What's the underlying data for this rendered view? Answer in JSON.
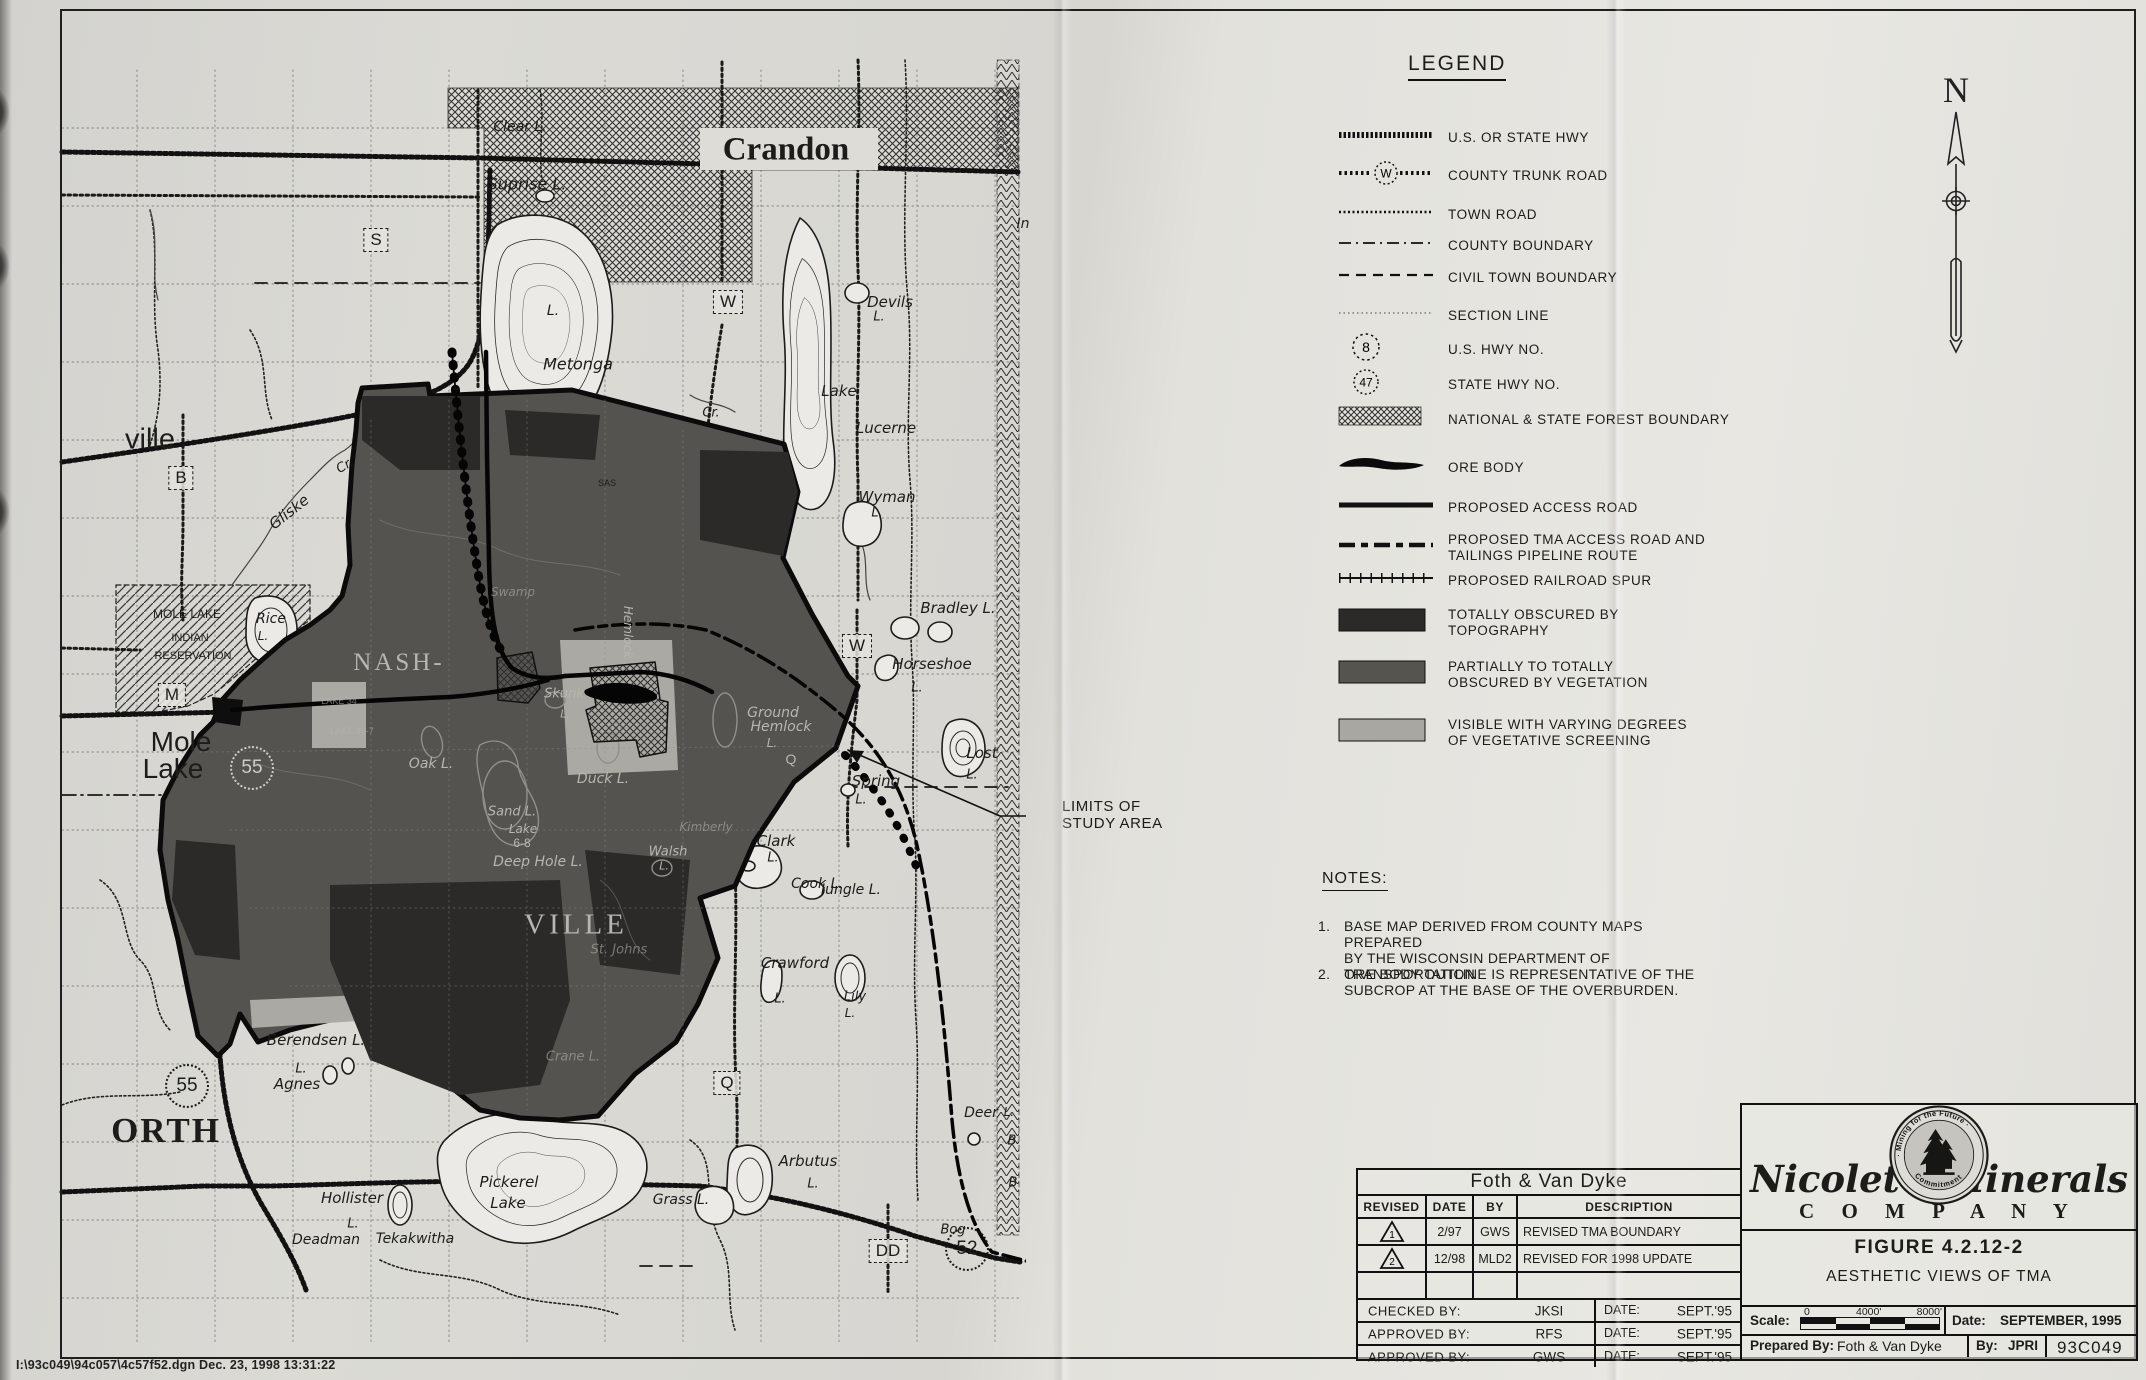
{
  "sheet": {
    "file_line": "I:\\93c049\\94c057\\4c57f52.dgn  Dec. 23, 1998  13:31:22"
  },
  "north_arrow": {
    "label": "N"
  },
  "colors": {
    "paper": "#e2e1dc",
    "ink": "#1c1c1a",
    "obscured_topography": "#2b2a28",
    "obscured_vegetation": "#55534f",
    "visible_screening": "#a9a7a2"
  },
  "legend": {
    "title": "LEGEND",
    "items": [
      {
        "symbol": "hwy",
        "label": "U.S. OR STATE HWY"
      },
      {
        "symbol": "trunk",
        "badge": "W",
        "label": "COUNTY TRUNK ROAD"
      },
      {
        "symbol": "town-road",
        "label": "TOWN ROAD"
      },
      {
        "symbol": "county-boundary",
        "label": "COUNTY BOUNDARY"
      },
      {
        "symbol": "civil-boundary",
        "label": "CIVIL TOWN BOUNDARY"
      },
      {
        "symbol": "section-line",
        "label": "SECTION LINE"
      },
      {
        "symbol": "us-hwy-badge",
        "badge": "8",
        "label": "U.S. HWY NO."
      },
      {
        "symbol": "state-hwy-badge",
        "badge": "47",
        "label": "STATE HWY NO."
      },
      {
        "symbol": "forest-hatch",
        "label": "NATIONAL & STATE FOREST BOUNDARY"
      },
      {
        "symbol": "ore-body",
        "label": "ORE BODY"
      },
      {
        "symbol": "access-road",
        "label": "PROPOSED ACCESS ROAD"
      },
      {
        "symbol": "tma-access",
        "label": "PROPOSED TMA ACCESS ROAD AND\nTAILINGS PIPELINE ROUTE"
      },
      {
        "symbol": "rail-spur",
        "label": "PROPOSED RAILROAD SPUR"
      },
      {
        "symbol": "swatch-dark",
        "label": "TOTALLY OBSCURED BY\nTOPOGRAPHY"
      },
      {
        "symbol": "swatch-medium",
        "label": "PARTIALLY TO TOTALLY\nOBSCURED BY VEGETATION"
      },
      {
        "symbol": "swatch-light",
        "label": "VISIBLE WITH VARYING DEGREES\nOF VEGETATIVE SCREENING"
      }
    ]
  },
  "notes": {
    "title": "NOTES:",
    "items": [
      "BASE MAP DERIVED FROM COUNTY MAPS PREPARED\nBY THE WISCONSIN DEPARTMENT OF TRANSPORTATION",
      "ORE BODY OUTLINE IS REPRESENTATIVE OF THE\nSUBCROP AT THE BASE OF THE OVERBURDEN."
    ]
  },
  "annotation": {
    "limits_lines": [
      "LIMITS OF",
      "STUDY AREA"
    ]
  },
  "title_block": {
    "firm": "Foth & Van Dyke",
    "rev_headers": [
      "REVISED",
      "DATE",
      "BY",
      "DESCRIPTION"
    ],
    "revisions": [
      {
        "mark": "1",
        "date": "2/97",
        "by": "GWS",
        "description": "REVISED TMA BOUNDARY"
      },
      {
        "mark": "2",
        "date": "12/98",
        "by": "MLD2",
        "description": "REVISED FOR 1998 UPDATE"
      }
    ],
    "signoff": [
      {
        "label": "CHECKED BY:",
        "name": "JKSI",
        "date_label": "DATE:",
        "date": "SEPT.'95"
      },
      {
        "label": "APPROVED BY:",
        "name": "RFS",
        "date_label": "DATE:",
        "date": "SEPT.'95"
      },
      {
        "label": "APPROVED BY:",
        "name": "GWS",
        "date_label": "DATE:",
        "date": "SEPT.'95"
      }
    ],
    "company": {
      "name_left": "Nicolet",
      "name_right": "Minerals",
      "company_word": "C O M P A N Y",
      "seal_top": "· Mining for the Future ·",
      "seal_bottom": "Commitment"
    },
    "figure_no": "FIGURE 4.2.12-2",
    "figure_title": "AESTHETIC VIEWS OF TMA",
    "scale_label": "Scale:",
    "scale_ticks": [
      "0",
      "4000'",
      "8000'"
    ],
    "date_label": "Date:",
    "date_value": "SEPTEMBER, 1995",
    "prepared_label": "Prepared By:",
    "prepared_value": "Foth & Van Dyke",
    "by_label": "By:",
    "by_value": "JPRI",
    "job_no": "93C049"
  },
  "map": {
    "boxes": [
      {
        "l": "S",
        "x": 376,
        "y": 240
      },
      {
        "l": "W",
        "x": 728,
        "y": 302
      },
      {
        "l": "B",
        "x": 181,
        "y": 478
      },
      {
        "l": "M",
        "x": 172,
        "y": 695
      },
      {
        "l": "W",
        "x": 857,
        "y": 646
      },
      {
        "l": "Q",
        "x": 727,
        "y": 1083
      },
      {
        "l": "DD",
        "x": 888,
        "y": 1251
      }
    ],
    "circles": [
      {
        "n": "55",
        "x": 252,
        "y": 768,
        "lt": 1
      },
      {
        "n": "55",
        "x": 187,
        "y": 1086
      },
      {
        "n": "52",
        "x": 967,
        "y": 1249
      }
    ],
    "labels": [
      {
        "t": "Crandon",
        "x": 786,
        "y": 150,
        "s": 33,
        "f": 1,
        "b": 1
      },
      {
        "t": "ville",
        "x": 150,
        "y": 440,
        "s": 29
      },
      {
        "t": "Mole",
        "x": 181,
        "y": 742,
        "s": 28
      },
      {
        "t": "Lake",
        "x": 173,
        "y": 769,
        "s": 28
      },
      {
        "t": "NASH-",
        "x": 399,
        "y": 663,
        "s": 25,
        "f": 1,
        "l": 1,
        "k": 3
      },
      {
        "t": "VILLE",
        "x": 576,
        "y": 925,
        "s": 29,
        "f": 1,
        "l": 1,
        "k": 4
      },
      {
        "t": "ORTH",
        "x": 166,
        "y": 1131,
        "s": 35,
        "f": 1,
        "b": 1,
        "k": 2
      },
      {
        "t": "Clear L.",
        "x": 520,
        "y": 127,
        "s": 14,
        "it": 1
      },
      {
        "t": "Suprise L.",
        "x": 527,
        "y": 184,
        "s": 16,
        "it": 1
      },
      {
        "t": "L.",
        "x": 553,
        "y": 311,
        "s": 14,
        "it": 1
      },
      {
        "t": "Metonga",
        "x": 578,
        "y": 364,
        "s": 16,
        "it": 1
      },
      {
        "t": "Cr.",
        "x": 711,
        "y": 413,
        "s": 13,
        "it": 1
      },
      {
        "t": "Devils",
        "x": 890,
        "y": 302,
        "s": 15,
        "it": 1
      },
      {
        "t": "L.",
        "x": 879,
        "y": 317,
        "s": 13,
        "it": 1
      },
      {
        "t": "Lake",
        "x": 839,
        "y": 391,
        "s": 15,
        "it": 1
      },
      {
        "t": "Lucerne",
        "x": 886,
        "y": 428,
        "s": 15,
        "it": 1
      },
      {
        "t": "Wyman",
        "x": 887,
        "y": 497,
        "s": 15,
        "it": 1
      },
      {
        "t": "L.",
        "x": 877,
        "y": 513,
        "s": 13,
        "it": 1
      },
      {
        "t": "In",
        "x": 1023,
        "y": 224,
        "s": 14,
        "it": 1
      },
      {
        "t": "SAS",
        "x": 607,
        "y": 483,
        "s": 9
      },
      {
        "t": "Gliske",
        "x": 289,
        "y": 512,
        "s": 15,
        "it": 1,
        "r": -38
      },
      {
        "t": "Cr.",
        "x": 345,
        "y": 466,
        "s": 13,
        "it": 1,
        "r": -30
      },
      {
        "t": "Rice",
        "x": 271,
        "y": 619,
        "s": 14,
        "it": 1
      },
      {
        "t": "L.",
        "x": 263,
        "y": 636,
        "s": 12,
        "it": 1
      },
      {
        "t": "MOLE LAKE",
        "x": 187,
        "y": 614,
        "s": 12
      },
      {
        "t": "INDIAN",
        "x": 190,
        "y": 638,
        "s": 11
      },
      {
        "t": "RESERVATION",
        "x": 193,
        "y": 656,
        "s": 11
      },
      {
        "t": "Bradley L.",
        "x": 958,
        "y": 608,
        "s": 15,
        "it": 1
      },
      {
        "t": "Horseshoe",
        "x": 932,
        "y": 664,
        "s": 15,
        "it": 1
      },
      {
        "t": "L.",
        "x": 917,
        "y": 688,
        "s": 13,
        "it": 1
      },
      {
        "t": "Ground",
        "x": 773,
        "y": 713,
        "s": 14,
        "it": 1,
        "l": 1
      },
      {
        "t": "Hemlock",
        "x": 781,
        "y": 727,
        "s": 14,
        "it": 1,
        "l": 1
      },
      {
        "t": "L.",
        "x": 772,
        "y": 743,
        "s": 12,
        "it": 1,
        "l": 1
      },
      {
        "t": "Q",
        "x": 791,
        "y": 759,
        "s": 14,
        "l": 1
      },
      {
        "t": "Lost",
        "x": 982,
        "y": 753,
        "s": 15,
        "it": 1
      },
      {
        "t": "L.",
        "x": 972,
        "y": 775,
        "s": 13,
        "it": 1
      },
      {
        "t": "Spring",
        "x": 876,
        "y": 781,
        "s": 15,
        "it": 1
      },
      {
        "t": "L.",
        "x": 861,
        "y": 800,
        "s": 13,
        "it": 1
      },
      {
        "t": "Clark",
        "x": 776,
        "y": 841,
        "s": 15,
        "it": 1
      },
      {
        "t": "L.",
        "x": 773,
        "y": 858,
        "s": 13,
        "it": 1
      },
      {
        "t": "Cook L.",
        "x": 817,
        "y": 884,
        "s": 14,
        "it": 1
      },
      {
        "t": "Jungle L.",
        "x": 851,
        "y": 890,
        "s": 14,
        "it": 1
      },
      {
        "t": "Walsh",
        "x": 668,
        "y": 852,
        "s": 13,
        "it": 1,
        "l": 1
      },
      {
        "t": "L.",
        "x": 664,
        "y": 866,
        "s": 11,
        "it": 1,
        "l": 1
      },
      {
        "t": "Oak L.",
        "x": 431,
        "y": 764,
        "s": 14,
        "it": 1,
        "l": 1
      },
      {
        "t": "Duck L.",
        "x": 603,
        "y": 779,
        "s": 14,
        "it": 1,
        "l": 1
      },
      {
        "t": "Skunk",
        "x": 564,
        "y": 694,
        "s": 13,
        "it": 1,
        "l": 1
      },
      {
        "t": "L.",
        "x": 565,
        "y": 714,
        "s": 11,
        "it": 1,
        "l": 1
      },
      {
        "t": "Sand L.",
        "x": 512,
        "y": 812,
        "s": 13,
        "it": 1,
        "l": 1
      },
      {
        "t": "Lake",
        "x": 523,
        "y": 829,
        "s": 12,
        "it": 1,
        "l": 1
      },
      {
        "t": "6-8",
        "x": 522,
        "y": 843,
        "s": 12,
        "l": 1
      },
      {
        "t": "Deep Hole L.",
        "x": 538,
        "y": 862,
        "s": 14,
        "it": 1,
        "l": 1
      },
      {
        "t": "LAKE 34",
        "x": 339,
        "y": 701,
        "s": 9,
        "l": 1,
        "o": 0.6
      },
      {
        "t": "LAKE 35-7",
        "x": 352,
        "y": 731,
        "s": 9,
        "l": 1,
        "o": 0.6
      },
      {
        "t": "Hemlock",
        "x": 628,
        "y": 632,
        "s": 12,
        "it": 1,
        "l": 1,
        "r": 90
      },
      {
        "t": "St. Johns",
        "x": 619,
        "y": 950,
        "s": 13,
        "it": 1,
        "l": 1,
        "o": 0.55
      },
      {
        "t": "Crane L.",
        "x": 573,
        "y": 1057,
        "s": 13,
        "it": 1,
        "l": 1,
        "o": 0.55
      },
      {
        "t": "Kimberly",
        "x": 706,
        "y": 827,
        "s": 12,
        "it": 1,
        "l": 1,
        "o": 0.55
      },
      {
        "t": "Swamp",
        "x": 513,
        "y": 592,
        "s": 12,
        "it": 1,
        "l": 1,
        "o": 0.55
      },
      {
        "t": "Berendsen L.",
        "x": 316,
        "y": 1040,
        "s": 15,
        "it": 1
      },
      {
        "t": "L.",
        "x": 301,
        "y": 1069,
        "s": 13,
        "it": 1
      },
      {
        "t": "Agnes",
        "x": 297,
        "y": 1084,
        "s": 15,
        "it": 1
      },
      {
        "t": "Hollister",
        "x": 352,
        "y": 1198,
        "s": 15,
        "it": 1
      },
      {
        "t": "L.",
        "x": 353,
        "y": 1224,
        "s": 13,
        "it": 1
      },
      {
        "t": "Deadman",
        "x": 326,
        "y": 1240,
        "s": 14,
        "it": 1
      },
      {
        "t": "Tekakwitha",
        "x": 415,
        "y": 1239,
        "s": 14,
        "it": 1
      },
      {
        "t": "Pickerel",
        "x": 509,
        "y": 1182,
        "s": 15,
        "it": 1
      },
      {
        "t": "Lake",
        "x": 508,
        "y": 1203,
        "s": 15,
        "it": 1
      },
      {
        "t": "Grass L.",
        "x": 681,
        "y": 1200,
        "s": 14,
        "it": 1
      },
      {
        "t": "Arbutus",
        "x": 808,
        "y": 1161,
        "s": 15,
        "it": 1
      },
      {
        "t": "L.",
        "x": 813,
        "y": 1184,
        "s": 13,
        "it": 1
      },
      {
        "t": "Deer",
        "x": 981,
        "y": 1113,
        "s": 14,
        "it": 1
      },
      {
        "t": "L.",
        "x": 1009,
        "y": 1112,
        "s": 12,
        "it": 1
      },
      {
        "t": "B",
        "x": 1012,
        "y": 1141,
        "s": 13,
        "it": 1
      },
      {
        "t": "B",
        "x": 1013,
        "y": 1183,
        "s": 13,
        "it": 1
      },
      {
        "t": "Bog",
        "x": 953,
        "y": 1230,
        "s": 13,
        "it": 1
      },
      {
        "t": "Crawford",
        "x": 795,
        "y": 963,
        "s": 15,
        "it": 1
      },
      {
        "t": "L.",
        "x": 780,
        "y": 999,
        "s": 13,
        "it": 1
      },
      {
        "t": "Lily",
        "x": 855,
        "y": 997,
        "s": 13,
        "it": 1
      },
      {
        "t": "L.",
        "x": 850,
        "y": 1013,
        "s": 12,
        "it": 1
      }
    ]
  }
}
